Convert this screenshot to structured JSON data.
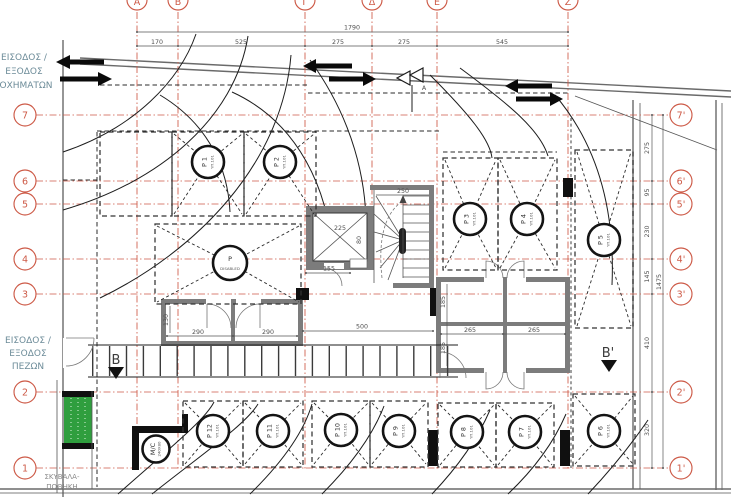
{
  "annotations": {
    "vehicle_entry": {
      "l1": "ΕΙΣΟΔΟΣ /",
      "l2": "ΕΞΟΔΟΣ",
      "l3": "ΟΧΗΜΑΤΩΝ"
    },
    "pedestrian_entry": {
      "l1": "ΕΙΣΟΔΟΣ /",
      "l2": "ΕΞΟΔΟΣ",
      "l3": "ΠΕΖΩΝ"
    },
    "waste_store": {
      "l1": "ΣΚΥΒΑΛΑ-",
      "l2": "ΠΟΘΗΚΗ"
    }
  },
  "grid": {
    "left_rows": [
      "7",
      "6",
      "5",
      "4",
      "3",
      "2",
      "1"
    ],
    "right_rows": [
      "7'",
      "6'",
      "5'",
      "4'",
      "3'",
      "2'",
      "1'"
    ],
    "top_cols": [
      "Α",
      "Β",
      "Γ",
      "Δ",
      "Ε",
      "Ζ"
    ]
  },
  "dimensions": {
    "top_total": "1790",
    "top_segments": [
      "170",
      "525",
      "275",
      "275",
      "545"
    ],
    "right_total": "1475",
    "right_segments": [
      "275",
      "95",
      "230",
      "145",
      "410",
      "320"
    ],
    "elevator_width": "225",
    "elevator_front": "155",
    "elevator_door": "80",
    "stair_width": "250",
    "store_w1": "290",
    "store_w2": "290",
    "store_h": "130",
    "aisle": "500",
    "block_w1": "265",
    "block_w2": "265",
    "block_h1": "185",
    "block_h2": "185"
  },
  "sections": {
    "left_marker": "B",
    "right_marker": "B'",
    "top_marker": "A"
  },
  "parking": {
    "sub_label": "ΥΠ.101",
    "spots": [
      {
        "id": "P 1"
      },
      {
        "id": "P 2"
      },
      {
        "id": "P 3"
      },
      {
        "id": "P 4"
      },
      {
        "id": "P 5"
      },
      {
        "id": "P 6"
      },
      {
        "id": "P 7"
      },
      {
        "id": "P 8"
      },
      {
        "id": "P 9"
      },
      {
        "id": "P 10"
      },
      {
        "id": "P 11"
      },
      {
        "id": "P 12"
      }
    ],
    "disabled": {
      "l1": "P",
      "l2": "DISABLED"
    },
    "moto": {
      "l1": "M/C",
      "l2": "240Χ80"
    }
  },
  "colors": {
    "grid_red": "#cd5a47",
    "ink": "#1d1d1d",
    "wall_gray": "#7c7c7c",
    "green": "#2f9e3e",
    "label_teal": "#6d8c99"
  }
}
